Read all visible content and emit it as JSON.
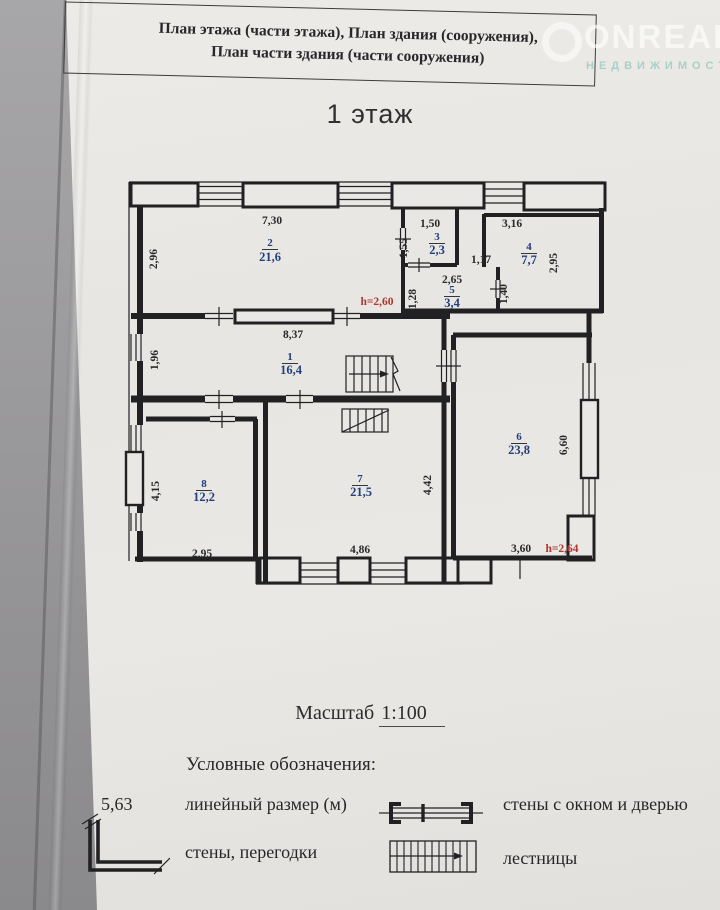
{
  "header": {
    "line1": "План этажа (части этажа), План здания (сооружения),",
    "line2": "План части здания (части сооружения)"
  },
  "watermark": {
    "brand": "ONREALT",
    "subtitle": "НЕДВИЖИМОСТЬ"
  },
  "floor_title": "1 этаж",
  "plan": {
    "rooms": {
      "r1": {
        "num": "1",
        "area": "16,4"
      },
      "r2": {
        "num": "2",
        "area": "21,6"
      },
      "r3": {
        "num": "3",
        "area": "2,3"
      },
      "r4": {
        "num": "4",
        "area": "7,7"
      },
      "r5": {
        "num": "5",
        "area": "3,4"
      },
      "r6": {
        "num": "6",
        "area": "23,8"
      },
      "r7": {
        "num": "7",
        "area": "21,5"
      },
      "r8": {
        "num": "8",
        "area": "12,2"
      }
    },
    "dims": {
      "room2_width": "7,30",
      "room2_height": "2,96",
      "room3_width": "1,50",
      "room3_height": "1,55",
      "room4_width": "3,16",
      "room4_height": "2,95",
      "niche_width": "1,17",
      "room5_width": "2,65",
      "room5_height": "1,28",
      "room5_door": "1,40",
      "room1_width": "8,37",
      "room1_height": "1,96",
      "room8_height": "4,15",
      "room8_width": "2,95",
      "room7_width": "4,86",
      "room7_height": "4,42",
      "room6_width": "3,60",
      "room6_height": "6,60"
    },
    "heights": {
      "room2": "h=2,60",
      "room6": "h=2,64"
    }
  },
  "scale": {
    "label": "Масштаб",
    "value": "1:100"
  },
  "legend": {
    "title": "Условные обозначения:",
    "linear_example": "5,63",
    "linear_label": "линейный размер (м)",
    "walls_label": "стены, перегодки",
    "window_door_label": "стены с окном и дверью",
    "stairs_label": "лестницы"
  },
  "colors": {
    "paper": "#e9e7e3",
    "backdrop": "#98979a",
    "wall": "#212124",
    "room_label": "#21407d",
    "dimension": "#2a2a2e",
    "height_note": "#b2342f"
  }
}
